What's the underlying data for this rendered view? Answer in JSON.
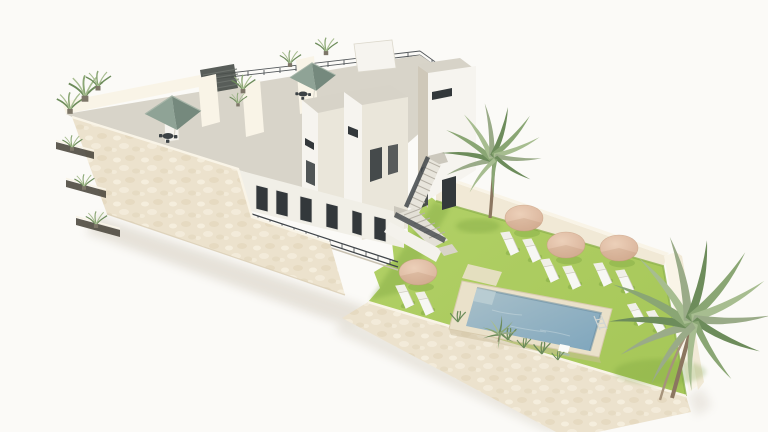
{
  "meta": {
    "title": "3D aerial architectural render of a residential complex with pool garden",
    "render_type": "isometric exterior visualization",
    "canvas": {
      "width": 768,
      "height": 432
    },
    "visible_text": "none"
  },
  "palette": {
    "bg": "#fbfaf7",
    "shadow": "#cdc5b6",
    "facade": "#ece2cd",
    "fleckLight": "#f5eedd",
    "fleckDark": "#dfd2b6",
    "wallTop": "#f9f4e7",
    "wallFace": "#f1e9d6",
    "deck": "#d8d4c9",
    "towerTop": "#d7d3c8",
    "towerLit": "#f6f4ef",
    "towerSide": "#eae6da",
    "towerShade": "#cfc8b9",
    "opening": "#33383b",
    "railing": "#41464a",
    "pergola": "#4a4f4b",
    "pergolaSlat": "#6d726d",
    "teal": "#8fa396",
    "tealLight": "#a9b7aa",
    "tealDark": "#75897d",
    "furniture": "#3c4245",
    "lawn": "#a4c556",
    "lawnLight": "#b2d167",
    "lawnShadow": "#6f9a38",
    "coping": "#eae1ca",
    "copingEdge": "#d8cbae",
    "waterLight": "#a9c0c9",
    "waterDark": "#7fa6bd",
    "waterStep": "#bccfd3",
    "parasol": "#d9b39a",
    "parasolDark": "#bc906e",
    "parasolLight": "#ecd0b9",
    "lounger": "#f7f7f3",
    "palm": "#8aa674",
    "palmDark": "#6d8c5b",
    "palmLight": "#a7bd90",
    "palmGray": "#9aab88",
    "trunk": "#a6937b",
    "trunkDark": "#8b7660"
  },
  "scene": {
    "building": {
      "label": "white two-storey residential block with cream stucco street wall",
      "facade_finish": "cream textured stucco",
      "planter_niches": 3,
      "towers": 3,
      "roof_terraces": {
        "teal_parasols": 2,
        "bistro_table_sets": 2,
        "potted_plants": 7,
        "pergola": 1,
        "perimeter_railing": true
      },
      "features": [
        "slit windows",
        "dark glazed doors",
        "balcony railings",
        "external staircase with two flights to garden"
      ]
    },
    "garden": {
      "label": "walled private pool garden",
      "lawn": true,
      "perimeter_wall_finish": "cream stucco",
      "pool": {
        "shape": "rectangular",
        "coping": "stone",
        "ladder": 1,
        "float": 1,
        "underwater_step": 1
      },
      "tan_parasols": 4,
      "sun_loungers": 10,
      "palm_trees_large": 2,
      "palm_trees_small": 1,
      "grass_tufts": true,
      "stone_pad": 1
    }
  }
}
